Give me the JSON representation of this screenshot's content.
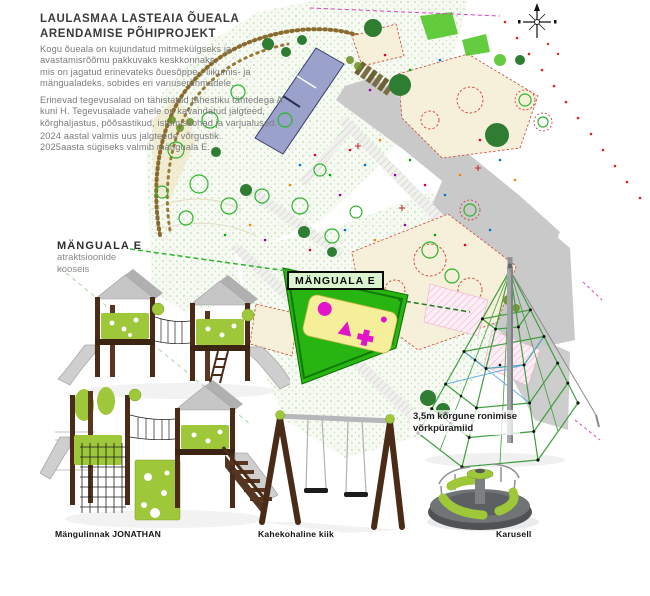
{
  "header": {
    "title_lines": [
      "LAULASMAA LASTEAIA ÕUEALA",
      "ARENDAMISE PÕHIPROJEKT"
    ],
    "paragraphs": [
      {
        "lines": [
          "Kogu õueala on kujundatud mitmekülgseks ja",
          "avastamisrõõmu pakkuvaks keskkonnaks,",
          "mis on jagatud erinevateks õuesõppe-, liikumis- ja",
          "mängualadeks, sobides eri vanuserühmadele."
        ]
      },
      {
        "lines": [
          "Erinevad tegevusalad on tähistatud tähestiku tähtedega A",
          "kuni H. Tegevusalade vahele on kavandatud jalgteed,",
          "kõrghaljastus, põõsastikud, istumiskohad ja varjualused."
        ]
      },
      {
        "lines": [
          "2024 aastal valmis uus jalgteede võrgustik.",
          "2025aasta sügiseks valmib mänguala E."
        ]
      }
    ]
  },
  "left_note": {
    "title": "MÄNGUALA E",
    "subtitle_lines": [
      "atraktsioonide",
      "kooseis"
    ]
  },
  "map": {
    "zone_label": "MÄNGUALA E"
  },
  "pyramid_note": {
    "lines": [
      "3,5m kõrgune ronimise",
      "võrkpüramiid"
    ]
  },
  "equipment": {
    "playground_label": "Mängulinnak JONATHAN",
    "swing_label": "Kahekohaline kiik",
    "carousel_label": "Karusell"
  },
  "colors": {
    "accent_lime": "#9ec73a",
    "wood_brown": "#4a2b18",
    "metal_gray": "#c6c6c6",
    "map_green": "#28b512",
    "pad_yellow": "#f5ef9a",
    "icon_magenta": "#e315cb",
    "zone_label_bg": "#d9f4cf",
    "road_gray": "#c9c9c9",
    "building_blue": "#9aa2cb",
    "ground_green": "#f6faf2",
    "title_color": "#3a3a3a",
    "body_text": "#7b7b7b"
  }
}
